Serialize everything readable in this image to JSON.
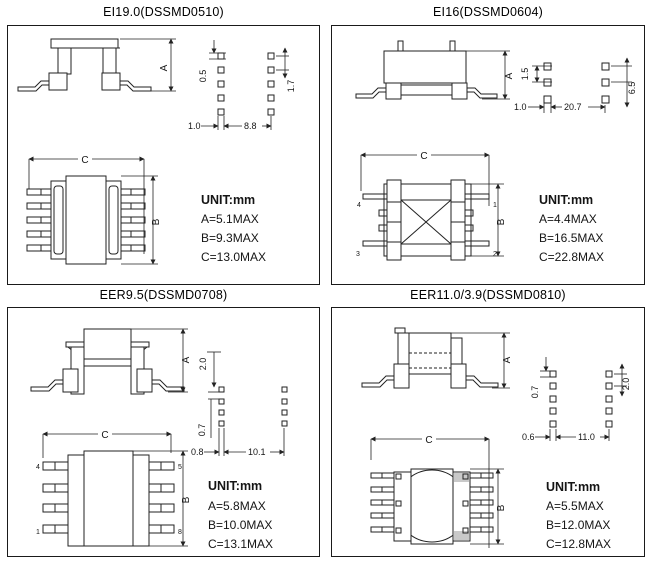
{
  "panels": [
    {
      "title": "EI19.0(DSSMD0510)",
      "unit": {
        "heading": "UNIT:mm",
        "a": "A=5.1MAX",
        "b": "B=9.3MAX",
        "c": "C=13.0MAX"
      },
      "dim_labels": {
        "a": "A",
        "b": "B",
        "c": "C"
      },
      "pad_dims": {
        "v_left": "0.5",
        "v_right": "1.7",
        "h_left": "1.0",
        "h_span": "8.8"
      },
      "pad_counts": {
        "left": 5,
        "right": 5
      }
    },
    {
      "title": "EI16(DSSMD0604)",
      "unit": {
        "heading": "UNIT:mm",
        "a": "A=4.4MAX",
        "b": "B=16.5MAX",
        "c": "C=22.8MAX"
      },
      "dim_labels": {
        "a": "A",
        "b": "B",
        "c": "C"
      },
      "pad_dims": {
        "v_left": "1.5",
        "v_right": "6.5",
        "h_left": "1.0",
        "h_span": "20.7"
      },
      "pad_counts": {
        "left": 3,
        "right": 3
      },
      "pin_labels": {
        "top_left": "4",
        "bottom_left": "3",
        "top_right": "1",
        "bottom_right": "2"
      }
    },
    {
      "title": "EER9.5(DSSMD0708)",
      "unit": {
        "heading": "UNIT:mm",
        "a": "A=5.8MAX",
        "b": "B=10.0MAX",
        "c": "C=13.1MAX"
      },
      "dim_labels": {
        "a": "A",
        "b": "B",
        "c": "C"
      },
      "pad_dims": {
        "v_top": "2.0",
        "v_left": "0.7",
        "h_left": "0.8",
        "h_span": "10.1"
      },
      "pad_counts": {
        "left": 4,
        "right": 4
      },
      "pin_labels": {
        "top_left": "4",
        "bottom_left": "1",
        "top_right": "5",
        "bottom_right": "8"
      }
    },
    {
      "title": "EER11.0/3.9(DSSMD0810)",
      "unit": {
        "heading": "UNIT:mm",
        "a": "A=5.5MAX",
        "b": "B=12.0MAX",
        "c": "C=12.8MAX"
      },
      "dim_labels": {
        "a": "A",
        "b": "B",
        "c": "C"
      },
      "pad_dims": {
        "v_left": "0.7",
        "v_right": "2.0",
        "h_left": "0.6",
        "h_span": "11.0"
      },
      "pad_counts": {
        "left": 5,
        "right": 5
      }
    }
  ]
}
